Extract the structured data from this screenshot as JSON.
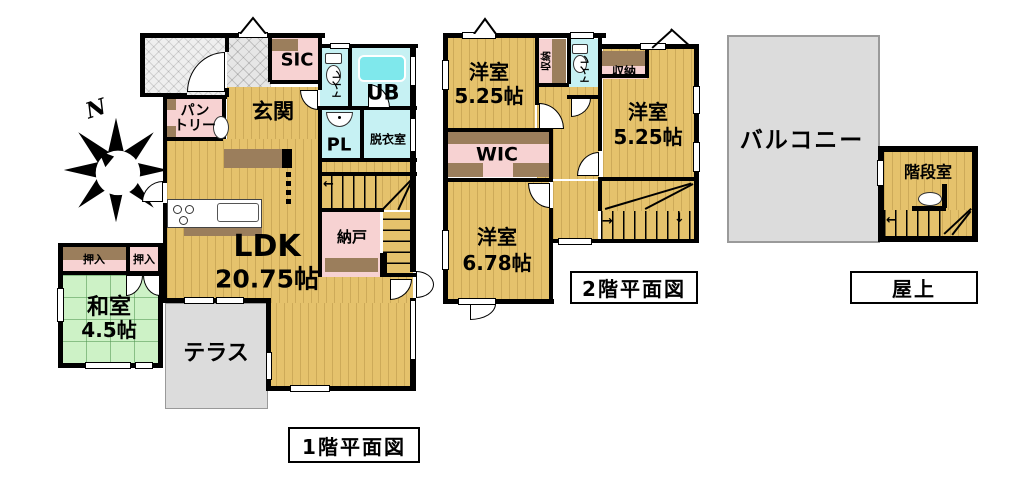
{
  "compass": {
    "north_label": "N"
  },
  "floor1": {
    "title": "1階平面図",
    "rooms": {
      "genkan": "玄関",
      "sic": "SIC",
      "pantry": "パン\nトリー",
      "toilet": "トイレ",
      "bath": "UB",
      "powder": "PL",
      "dressing": "脱衣室",
      "ldk": {
        "name": "LDK",
        "size": "20.75帖"
      },
      "storage": "納戸",
      "closet_left": "押入",
      "closet_right": "押入",
      "washitsu": {
        "name": "和室",
        "size": "4.5帖"
      },
      "terrace": "テラス"
    }
  },
  "floor2": {
    "title": "2階平面図",
    "rooms": {
      "bedroom1": {
        "name": "洋室",
        "size": "5.25帖"
      },
      "closet1": "収納",
      "toilet": "トイレ",
      "closet2": "収納",
      "bedroom2": {
        "name": "洋室",
        "size": "5.25帖"
      },
      "wic": "WIC",
      "bedroom3": {
        "name": "洋室",
        "size": "6.78帖"
      }
    }
  },
  "roof": {
    "title": "屋上",
    "rooms": {
      "balcony": "バルコニー",
      "stair_room": "階段室"
    }
  },
  "colors": {
    "wood_floor": "#E5C26C",
    "tatami_green": "#CDF2C6",
    "closet_pink": "#F7D2D2",
    "closet_brown": "#9B7E5C",
    "wet_area_cyan": "#C6F1F3",
    "bathtub_cyan": "#7FE8EC",
    "terrace_gray": "#DCDCDC",
    "wall_black": "#000000"
  }
}
